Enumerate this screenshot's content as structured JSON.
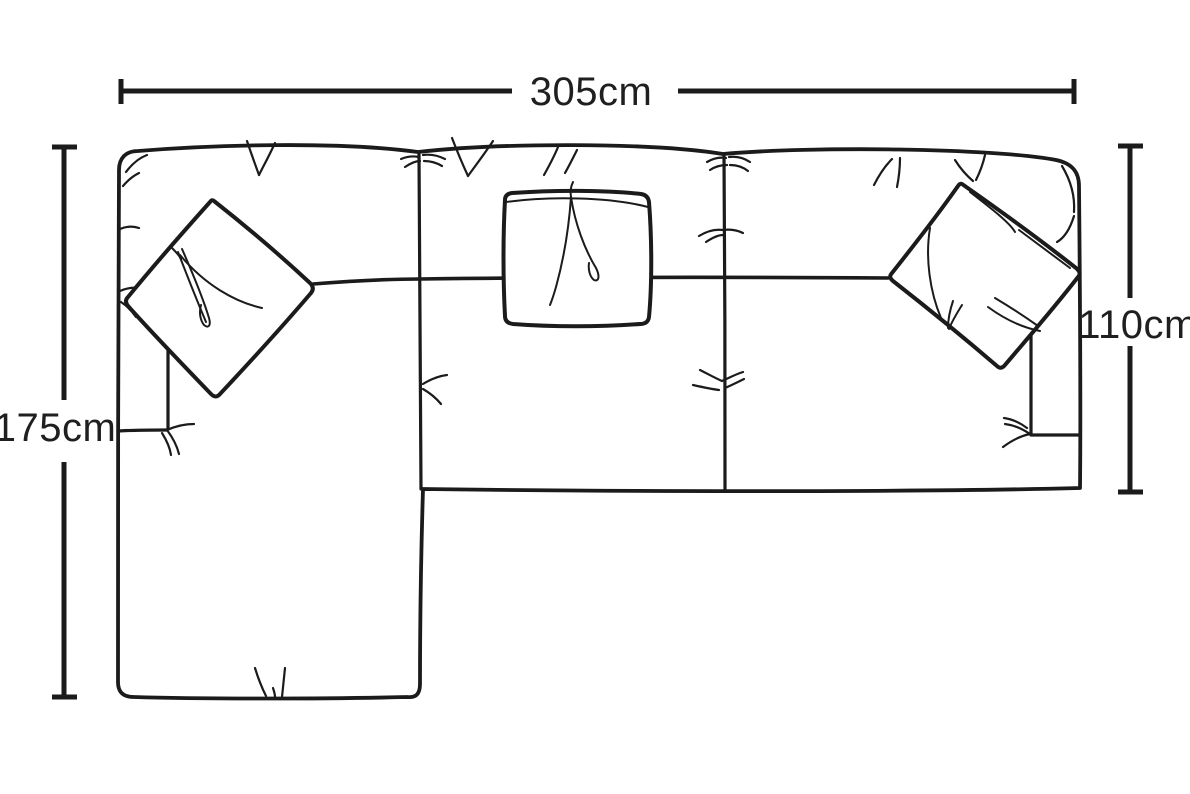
{
  "diagram": {
    "title": "sofa top view dimension diagram",
    "background_color": "#ffffff",
    "line_color": "#1b1b1b",
    "dimensions": {
      "overall_width": "305cm",
      "chaise_depth": "175cm",
      "sofa_depth": "110cm"
    }
  }
}
